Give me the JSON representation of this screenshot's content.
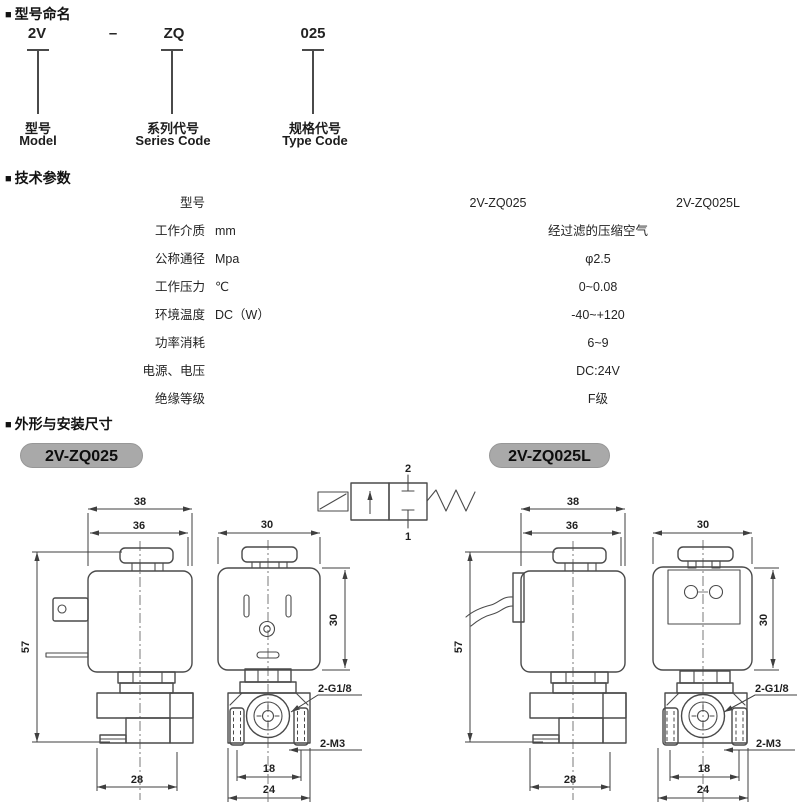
{
  "sections": {
    "bullet": "■",
    "naming_title": "型号命名",
    "params_title": "技术参数",
    "dims_title": "外形与安装尺寸"
  },
  "naming": {
    "dash": "–",
    "items": [
      {
        "code": "2V",
        "label_cn": "型号",
        "label_en": "Model"
      },
      {
        "code": "ZQ",
        "label_cn": "系列代号",
        "label_en": "Series Code"
      },
      {
        "code": "025",
        "label_cn": "规格代号",
        "label_en": "Type Code"
      }
    ]
  },
  "params": {
    "rows": [
      {
        "name": "型号",
        "unit": "",
        "value1": "2V-ZQ025",
        "value2": "2V-ZQ025L"
      },
      {
        "name": "工作介质",
        "unit": "mm",
        "merged": "经过滤的压缩空气"
      },
      {
        "name": "公称通径",
        "unit": "Mpa",
        "merged": "φ2.5"
      },
      {
        "name": "工作压力",
        "unit": "℃",
        "merged": "0~0.08"
      },
      {
        "name": "环境温度",
        "unit": "DC（W）",
        "merged": "-40~+120"
      },
      {
        "name": "功率消耗",
        "unit": "",
        "merged": "6~9"
      },
      {
        "name": "电源、电压",
        "unit": "",
        "merged": "DC:24V"
      },
      {
        "name": "绝缘等级",
        "unit": "",
        "merged": "F级"
      }
    ]
  },
  "drawings": {
    "badge_left": "2V-ZQ025",
    "badge_right": "2V-ZQ025L",
    "symbol": {
      "port_top": "2",
      "port_bottom": "1"
    },
    "left_side": {
      "width_outer": "38",
      "width_inner": "36",
      "height": "57",
      "base_width": "28"
    },
    "left_front": {
      "width_top": "30",
      "height_right": "30",
      "port_thread": "2-G1/8",
      "mount_thread": "2-M3",
      "hole_spacing": "18",
      "base_width": "24"
    },
    "right_side": {
      "width_outer": "38",
      "width_inner": "36",
      "height": "57",
      "base_width": "28"
    },
    "right_front": {
      "width_top": "30",
      "height_right": "30",
      "port_thread": "2-G1/8",
      "mount_thread": "2-M3",
      "hole_spacing": "18",
      "base_width": "24"
    }
  }
}
